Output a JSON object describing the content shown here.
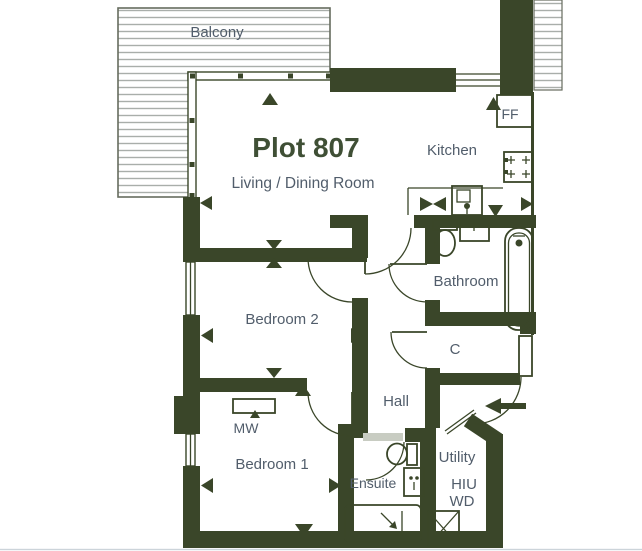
{
  "theme": {
    "wall_color": "#3a4629",
    "text_color": "#515d6b",
    "title_color": "#3f4f35",
    "hatch_line_color": "#a9aeaa",
    "hatch_border_color": "#666c5e",
    "bg_color": "#ffffff",
    "edge_color": "#ccd4da"
  },
  "plan": {
    "title": "Plot 807",
    "labels": {
      "balcony": "Balcony",
      "living": "Living / Dining Room",
      "kitchen": "Kitchen",
      "fridge_freezer": "FF",
      "bathroom": "Bathroom",
      "bedroom2": "Bedroom 2",
      "cupboard": "C",
      "hall": "Hall",
      "microwave_wardrobe": "MW",
      "bedroom1": "Bedroom 1",
      "ensuite": "Ensuite",
      "utility": "Utility",
      "hiu": "HIU",
      "wd": "WD"
    }
  }
}
